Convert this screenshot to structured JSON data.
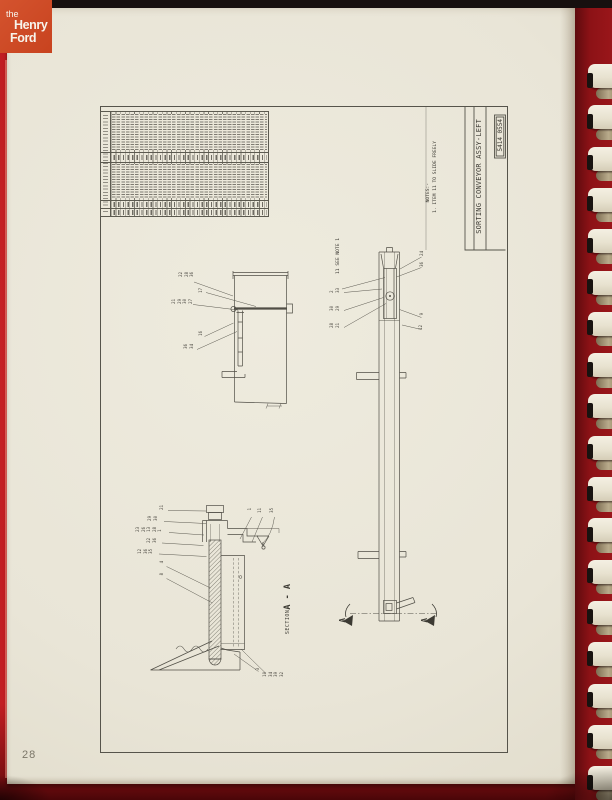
{
  "logo": {
    "the": "the",
    "henry": "Henry",
    "ford": "Ford"
  },
  "page": {
    "number": "28"
  },
  "binding": {
    "tooth_count": 18
  },
  "drawing": {
    "title": "SORTING CONVEYOR ASSY-LEFT",
    "drawing_number": "5414 0554",
    "notes": {
      "heading": "NOTES:-",
      "item": "1. ITEM 11 TO SLIDE FREELY"
    },
    "side_view_note": "11 SEE NOTE 1",
    "section_view": {
      "label_prefix": "SECTION",
      "label_letters": "A - A"
    },
    "section_arrow_letter": "A",
    "parts_table": {
      "legible": false,
      "columns": 35
    },
    "callouts": [
      {
        "view": "end-view",
        "x": 179,
        "y": 272,
        "nums": [
          "22",
          "28",
          "36"
        ]
      },
      {
        "view": "end-view",
        "x": 199,
        "y": 288,
        "nums": [
          "17"
        ]
      },
      {
        "view": "end-view",
        "x": 172,
        "y": 299,
        "nums": [
          "21",
          "29",
          "30",
          "27"
        ]
      },
      {
        "view": "end-view",
        "x": 199,
        "y": 331,
        "nums": [
          "16"
        ]
      },
      {
        "view": "end-view",
        "x": 184,
        "y": 344,
        "nums": [
          "36",
          "34"
        ]
      },
      {
        "view": "side-view",
        "x": 420,
        "y": 251,
        "nums": [
          "24"
        ]
      },
      {
        "view": "side-view",
        "x": 420,
        "y": 262,
        "nums": [
          "36"
        ]
      },
      {
        "view": "side-view",
        "x": 330,
        "y": 288,
        "nums": [
          "2",
          "33"
        ]
      },
      {
        "view": "side-view",
        "x": 330,
        "y": 306,
        "nums": [
          "30",
          "29"
        ]
      },
      {
        "view": "side-view",
        "x": 330,
        "y": 323,
        "nums": [
          "28",
          "21"
        ]
      },
      {
        "view": "side-view",
        "x": 420,
        "y": 313,
        "nums": [
          "9"
        ]
      },
      {
        "view": "side-view",
        "x": 419,
        "y": 325,
        "nums": [
          "12"
        ]
      },
      {
        "view": "section-view",
        "x": 160,
        "y": 505,
        "nums": [
          "21"
        ]
      },
      {
        "view": "section-view",
        "x": 148,
        "y": 516,
        "nums": [
          "29",
          "30"
        ]
      },
      {
        "view": "section-view",
        "x": 136,
        "y": 527,
        "nums": [
          "23",
          "26",
          "13",
          "28",
          "1"
        ]
      },
      {
        "view": "section-view",
        "x": 147,
        "y": 538,
        "nums": [
          "22",
          "36"
        ]
      },
      {
        "view": "section-view",
        "x": 138,
        "y": 549,
        "nums": [
          "12",
          "36",
          "35"
        ]
      },
      {
        "view": "section-view",
        "x": 160,
        "y": 561,
        "nums": [
          "4"
        ]
      },
      {
        "view": "section-view",
        "x": 160,
        "y": 573,
        "nums": [
          "8"
        ]
      },
      {
        "view": "section-view",
        "x": 248,
        "y": 508,
        "nums": [
          "1"
        ]
      },
      {
        "view": "section-view",
        "x": 258,
        "y": 508,
        "nums": [
          "11"
        ]
      },
      {
        "view": "section-view",
        "x": 270,
        "y": 508,
        "nums": [
          "35"
        ]
      },
      {
        "view": "section-view",
        "x": 256,
        "y": 668,
        "nums": [
          "3"
        ]
      },
      {
        "view": "section-view",
        "x": 263,
        "y": 672,
        "nums": [
          "10",
          "34",
          "39",
          "32"
        ]
      }
    ]
  }
}
